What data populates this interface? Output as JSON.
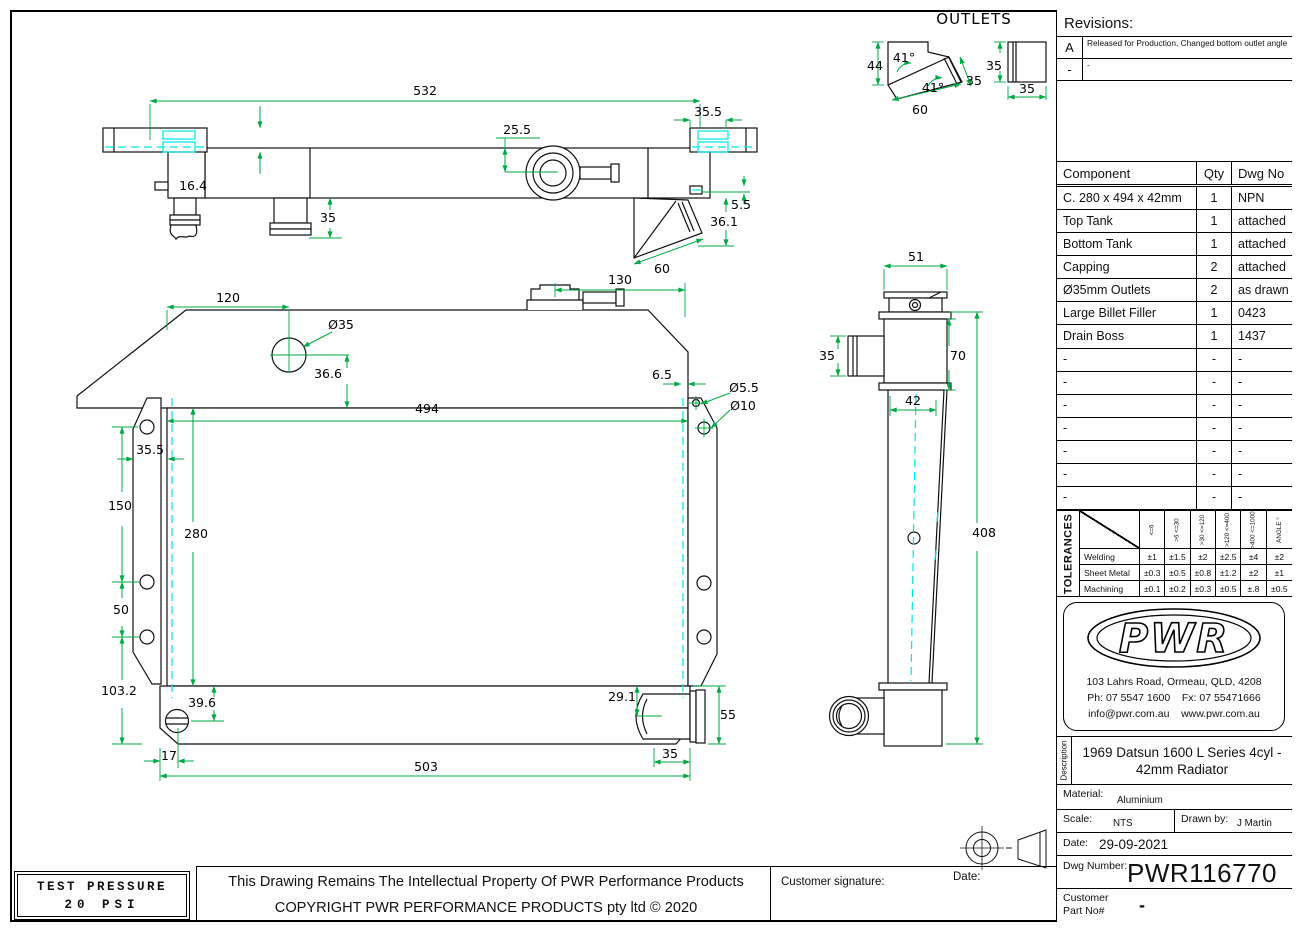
{
  "sheet": {
    "bg": "#ffffff",
    "line_color": "#111111",
    "dim_color": "#00aa46",
    "centerline_color": "#00e5e5"
  },
  "revisions": {
    "title": "Revisions:",
    "rows": [
      {
        "rev": "A",
        "note": "Released for Production, Changed bottom outlet angle"
      },
      {
        "rev": "-",
        "note": "-"
      }
    ]
  },
  "components": {
    "headers": [
      "Component",
      "Qty",
      "Dwg No"
    ],
    "rows": [
      [
        "C. 280 x 494 x 42mm",
        "1",
        "NPN"
      ],
      [
        "Top Tank",
        "1",
        "attached"
      ],
      [
        "Bottom Tank",
        "1",
        "attached"
      ],
      [
        "Capping",
        "2",
        "attached"
      ],
      [
        "Ø35mm Outlets",
        "2",
        "as drawn"
      ],
      [
        "Large Billet Filler",
        "1",
        "0423"
      ],
      [
        "Drain Boss",
        "1",
        "1437"
      ],
      [
        "-",
        "-",
        "-"
      ],
      [
        "-",
        "-",
        "-"
      ],
      [
        "-",
        "-",
        "-"
      ],
      [
        "-",
        "-",
        "-"
      ],
      [
        "-",
        "-",
        "-"
      ],
      [
        "-",
        "-",
        "-"
      ],
      [
        "-",
        "-",
        "-"
      ]
    ]
  },
  "tolerances": {
    "label": "TOLERANCES",
    "col_headers": [
      "<=6",
      ">6 <=30",
      ">30 <=120",
      ">120 <=400",
      ">400 <=1000",
      "ANGLE °"
    ],
    "rows": [
      {
        "name": "Welding",
        "values": [
          "±1",
          "±1.5",
          "±2",
          "±2.5",
          "±4",
          "±2"
        ]
      },
      {
        "name": "Sheet Metal",
        "values": [
          "±0.3",
          "±0.5",
          "±0.8",
          "±1.2",
          "±2",
          "±1"
        ]
      },
      {
        "name": "Machining",
        "values": [
          "±0.1",
          "±0.2",
          "±0.3",
          "±0.5",
          "±.8",
          "±0.5"
        ]
      }
    ]
  },
  "company": {
    "logo_text": "PWR",
    "address": "103 Lahrs Road, Ormeau, QLD, 4208",
    "phone_fax": "Ph: 07 5547 1600    Fx: 07 55471666",
    "email_web": "info@pwr.com.au    www.pwr.com.au"
  },
  "title_block": {
    "description_label": "Description",
    "description_line1": "1969 Datsun 1600 L Series 4cyl -",
    "description_line2": "42mm Radiator",
    "material_label": "Material:",
    "material": "Aluminium",
    "scale_label": "Scale:",
    "scale": "NTS",
    "drawn_by_label": "Drawn by:",
    "drawn_by": "J Martin",
    "date_label": "Date:",
    "date": "29-09-2021",
    "dwg_number_label": "Dwg Number:",
    "dwg_number": "PWR116770",
    "customer_part_label_line1": "Customer",
    "customer_part_label_line2": "Part No#",
    "customer_part_value": "-"
  },
  "footer": {
    "test_pressure_line1": "TEST PRESSURE",
    "test_pressure_line2": "20 PSI",
    "copyright_line1": "This Drawing Remains The Intellectual Property Of PWR Performance Products",
    "copyright_line2": "COPYRIGHT PWR PERFORMANCE PRODUCTS pty ltd © 2020",
    "customer_signature_label": "Customer signature:",
    "date_label": "Date:"
  },
  "drawing": {
    "outlets_title": "OUTLETS",
    "dim_labels": [
      {
        "t": "532",
        "x": 425,
        "y": 95
      },
      {
        "t": "16.4",
        "x": 193,
        "y": 190
      },
      {
        "t": "25.5",
        "x": 517,
        "y": 134
      },
      {
        "t": "35",
        "x": 328,
        "y": 222
      },
      {
        "t": "35.5",
        "x": 708,
        "y": 116
      },
      {
        "t": "5.5",
        "x": 741,
        "y": 209
      },
      {
        "t": "36.1",
        "x": 724,
        "y": 226
      },
      {
        "t": "60",
        "x": 662,
        "y": 273
      },
      {
        "t": "130",
        "x": 620,
        "y": 284
      },
      {
        "t": "44",
        "x": 875,
        "y": 70
      },
      {
        "t": "41°",
        "x": 904,
        "y": 62
      },
      {
        "t": "41°",
        "x": 933,
        "y": 92
      },
      {
        "t": "35",
        "x": 974,
        "y": 85
      },
      {
        "t": "60",
        "x": 920,
        "y": 114
      },
      {
        "t": "35",
        "x": 994,
        "y": 70
      },
      {
        "t": "35",
        "x": 1027,
        "y": 93
      },
      {
        "t": "51",
        "x": 916,
        "y": 261
      },
      {
        "t": "35",
        "x": 827,
        "y": 360
      },
      {
        "t": "70",
        "x": 958,
        "y": 360
      },
      {
        "t": "42",
        "x": 913,
        "y": 405
      },
      {
        "t": "408",
        "x": 984,
        "y": 537
      },
      {
        "t": "120",
        "x": 228,
        "y": 302
      },
      {
        "t": "Ø35",
        "x": 341,
        "y": 329
      },
      {
        "t": "36.6",
        "x": 328,
        "y": 378
      },
      {
        "t": "494",
        "x": 427,
        "y": 413
      },
      {
        "t": "6.5",
        "x": 662,
        "y": 379
      },
      {
        "t": "Ø5.5",
        "x": 744,
        "y": 392
      },
      {
        "t": "Ø10",
        "x": 743,
        "y": 410
      },
      {
        "t": "35.5",
        "x": 150,
        "y": 454
      },
      {
        "t": "150",
        "x": 120,
        "y": 510
      },
      {
        "t": "280",
        "x": 196,
        "y": 538
      },
      {
        "t": "50",
        "x": 121,
        "y": 614
      },
      {
        "t": "103.2",
        "x": 119,
        "y": 695
      },
      {
        "t": "39.6",
        "x": 202,
        "y": 707
      },
      {
        "t": "17",
        "x": 169,
        "y": 760
      },
      {
        "t": "503",
        "x": 426,
        "y": 771
      },
      {
        "t": "29.1",
        "x": 622,
        "y": 701
      },
      {
        "t": "55",
        "x": 728,
        "y": 719
      },
      {
        "t": "35",
        "x": 670,
        "y": 758
      }
    ]
  }
}
